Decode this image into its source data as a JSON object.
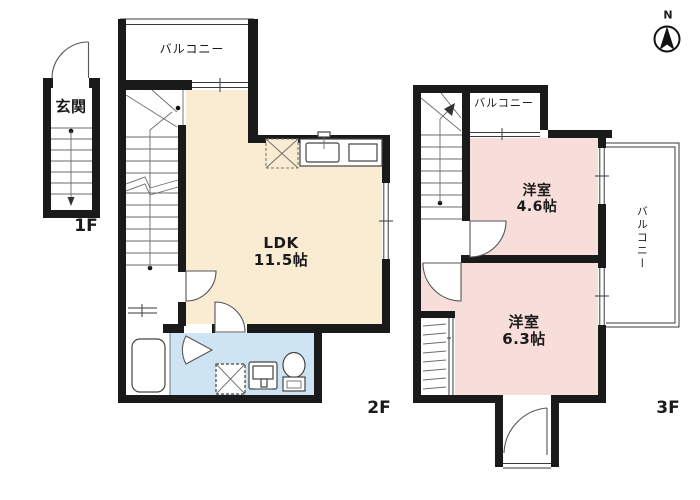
{
  "colors": {
    "wall": "#1a1a1a",
    "ldk_fill": "#FAECD2",
    "room_fill": "#F8DEDA",
    "wet_fill": "#CFE4F2"
  },
  "compass": {
    "north_label": "N"
  },
  "floor1": {
    "label": "1F",
    "entrance": "玄関"
  },
  "floor2": {
    "label": "2F",
    "balcony": "バルコニー",
    "ldk_name": "LDK",
    "ldk_size": "11.5帖"
  },
  "floor3": {
    "label": "3F",
    "balcony_top": "バルコニー",
    "balcony_side": "バルコニー",
    "room_a_name": "洋室",
    "room_a_size": "4.6帖",
    "room_b_name": "洋室",
    "room_b_size": "6.3帖"
  }
}
